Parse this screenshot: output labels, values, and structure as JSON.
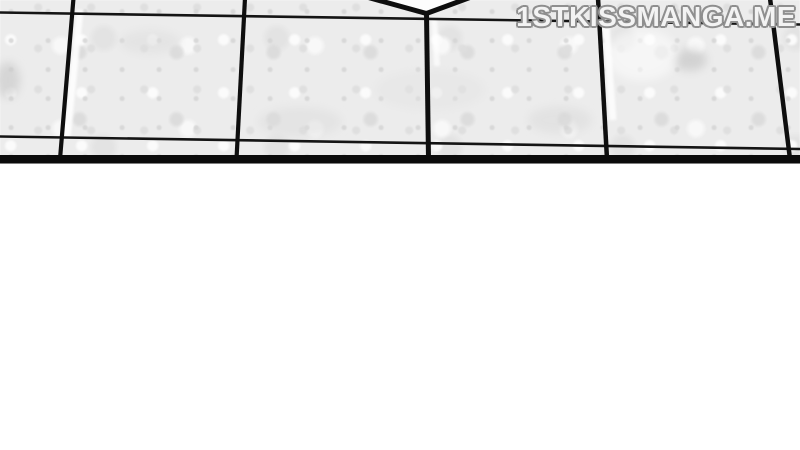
{
  "page": {
    "type": "manga-panel-fragment",
    "watermark": {
      "text": "1STKISSMANGA.ME",
      "fill_color": "#f3f3f3",
      "outline_color": "#8f8f8f"
    },
    "panel": {
      "subject": "tiled floor seen in perspective, bottom edge of a comic panel",
      "ink_color": "#0e0e0e",
      "tile_base_color": "#ececec",
      "tile_shadow_color": "#d9d9d9",
      "tile_highlight_color": "#fbfbfb",
      "panel_border_color": "#0b0b0b",
      "gutter_color": "#ffffff"
    }
  }
}
